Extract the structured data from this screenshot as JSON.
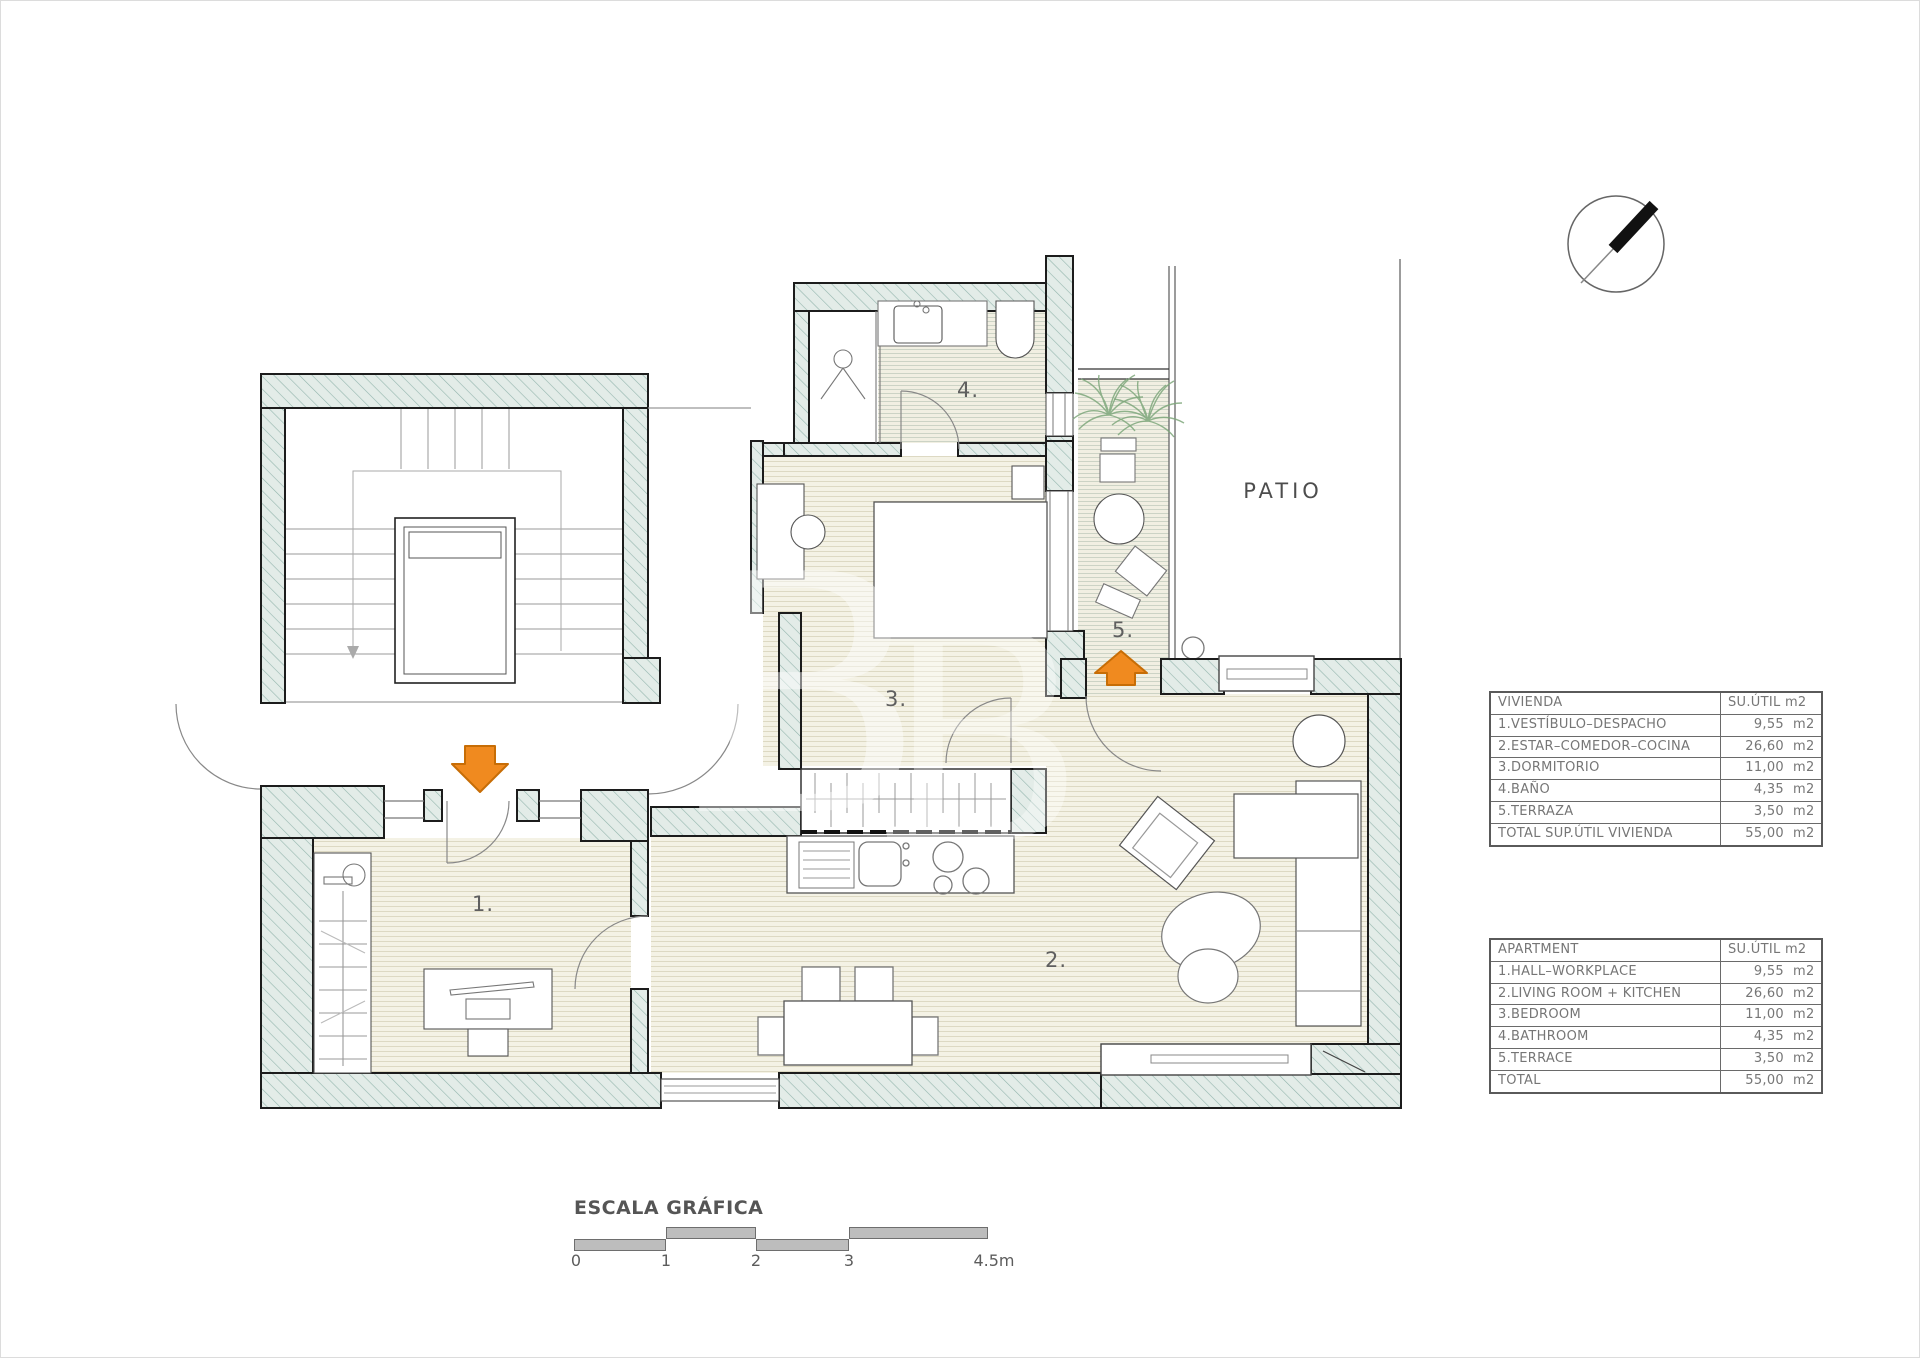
{
  "colors": {
    "wall_fill": "#e3ece8",
    "wall_hatch": "#93b5ad",
    "wall_edge": "#1c1c1c",
    "floor_fill": "#f4f2e5",
    "floor_line": "#ddd9c3",
    "tile_line": "#ccd3c5",
    "entrance_arrow_orange": "#f08a1f",
    "plant_green": "#7fa87c",
    "text_gray": "#6f6f6f"
  },
  "plan": {
    "labels": {
      "room1": "1.",
      "room2": "2.",
      "room3": "3.",
      "room4": "4.",
      "room5": "5.",
      "patio": "PATIO"
    },
    "watermark": {
      "glyph1": "B",
      "glyph2": "B"
    }
  },
  "area_tables": [
    {
      "id": "vivienda",
      "header": {
        "name": "VIVIENDA",
        "unit": "SU.ÚTIL  m2"
      },
      "rows": [
        {
          "label": "1.VESTÍBULO–DESPACHO",
          "value": "9,55",
          "unit": "m2"
        },
        {
          "label": "2.ESTAR–COMEDOR–COCINA",
          "value": "26,60",
          "unit": "m2"
        },
        {
          "label": "3.DORMITORIO",
          "value": "11,00",
          "unit": "m2"
        },
        {
          "label": "4.BAÑO",
          "value": "4,35",
          "unit": "m2"
        },
        {
          "label": "5.TERRAZA",
          "value": "3,50",
          "unit": "m2"
        },
        {
          "label": "TOTAL SUP.ÚTIL VIVIENDA",
          "value": "55,00",
          "unit": "m2"
        }
      ]
    },
    {
      "id": "apartment",
      "header": {
        "name": "APARTMENT",
        "unit": "SU.ÚTIL  m2"
      },
      "rows": [
        {
          "label": "1.HALL–WORKPLACE",
          "value": "9,55",
          "unit": "m2"
        },
        {
          "label": "2.LIVING ROOM + KITCHEN",
          "value": "26,60",
          "unit": "m2"
        },
        {
          "label": "3.BEDROOM",
          "value": "11,00",
          "unit": "m2"
        },
        {
          "label": "4.BATHROOM",
          "value": "4,35",
          "unit": "m2"
        },
        {
          "label": "5.TERRACE",
          "value": "3,50",
          "unit": "m2"
        },
        {
          "label": "TOTAL",
          "value": "55,00",
          "unit": "m2"
        }
      ]
    }
  ],
  "scale_bar": {
    "title": "ESCALA GRÁFICA",
    "ticks": [
      "0",
      "1",
      "2",
      "3",
      "4.5m"
    ]
  }
}
